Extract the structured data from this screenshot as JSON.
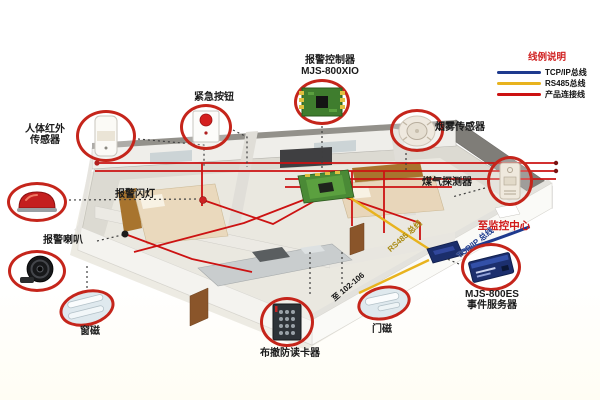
{
  "legend": {
    "title": "线例说明",
    "items": [
      {
        "name": "tcpip-bus",
        "label": "TCP/IP总线",
        "color": "#1e3a8e"
      },
      {
        "name": "rs485-bus",
        "label": "RS485总线",
        "color": "#e8b31e"
      },
      {
        "name": "product-link",
        "label": "产品连接线",
        "color": "#cc1212"
      }
    ]
  },
  "colors": {
    "tcpip": "#1e3a8e",
    "rs485": "#e8b31e",
    "product": "#cc1212",
    "ring": "#c5251b"
  },
  "callouts": {
    "controller": {
      "line1": "报警控制器",
      "line2": "MJS-800XIO"
    },
    "emergency": {
      "label": "紧急按钮"
    },
    "pir": {
      "line1": "人体红外",
      "line2": "传感器"
    },
    "strobe": {
      "label": "报警闪灯"
    },
    "horn": {
      "label": "报警喇叭"
    },
    "window_magnet": {
      "label": "窗磁"
    },
    "card_reader": {
      "label": "布撤防读卡器"
    },
    "door_magnet": {
      "label": "门磁"
    },
    "smoke": {
      "label": "烟雾传感器"
    },
    "gas": {
      "label": "煤气探测器"
    },
    "server": {
      "line1": "MJS-800ES",
      "line2": "事件服务器"
    }
  },
  "annotations": {
    "to_monitor_center": "至监控中心",
    "tcpip_bus": "TCP/IP 总线",
    "rs485_bus": "RS485 总线",
    "to_rooms": "至 102-106"
  }
}
